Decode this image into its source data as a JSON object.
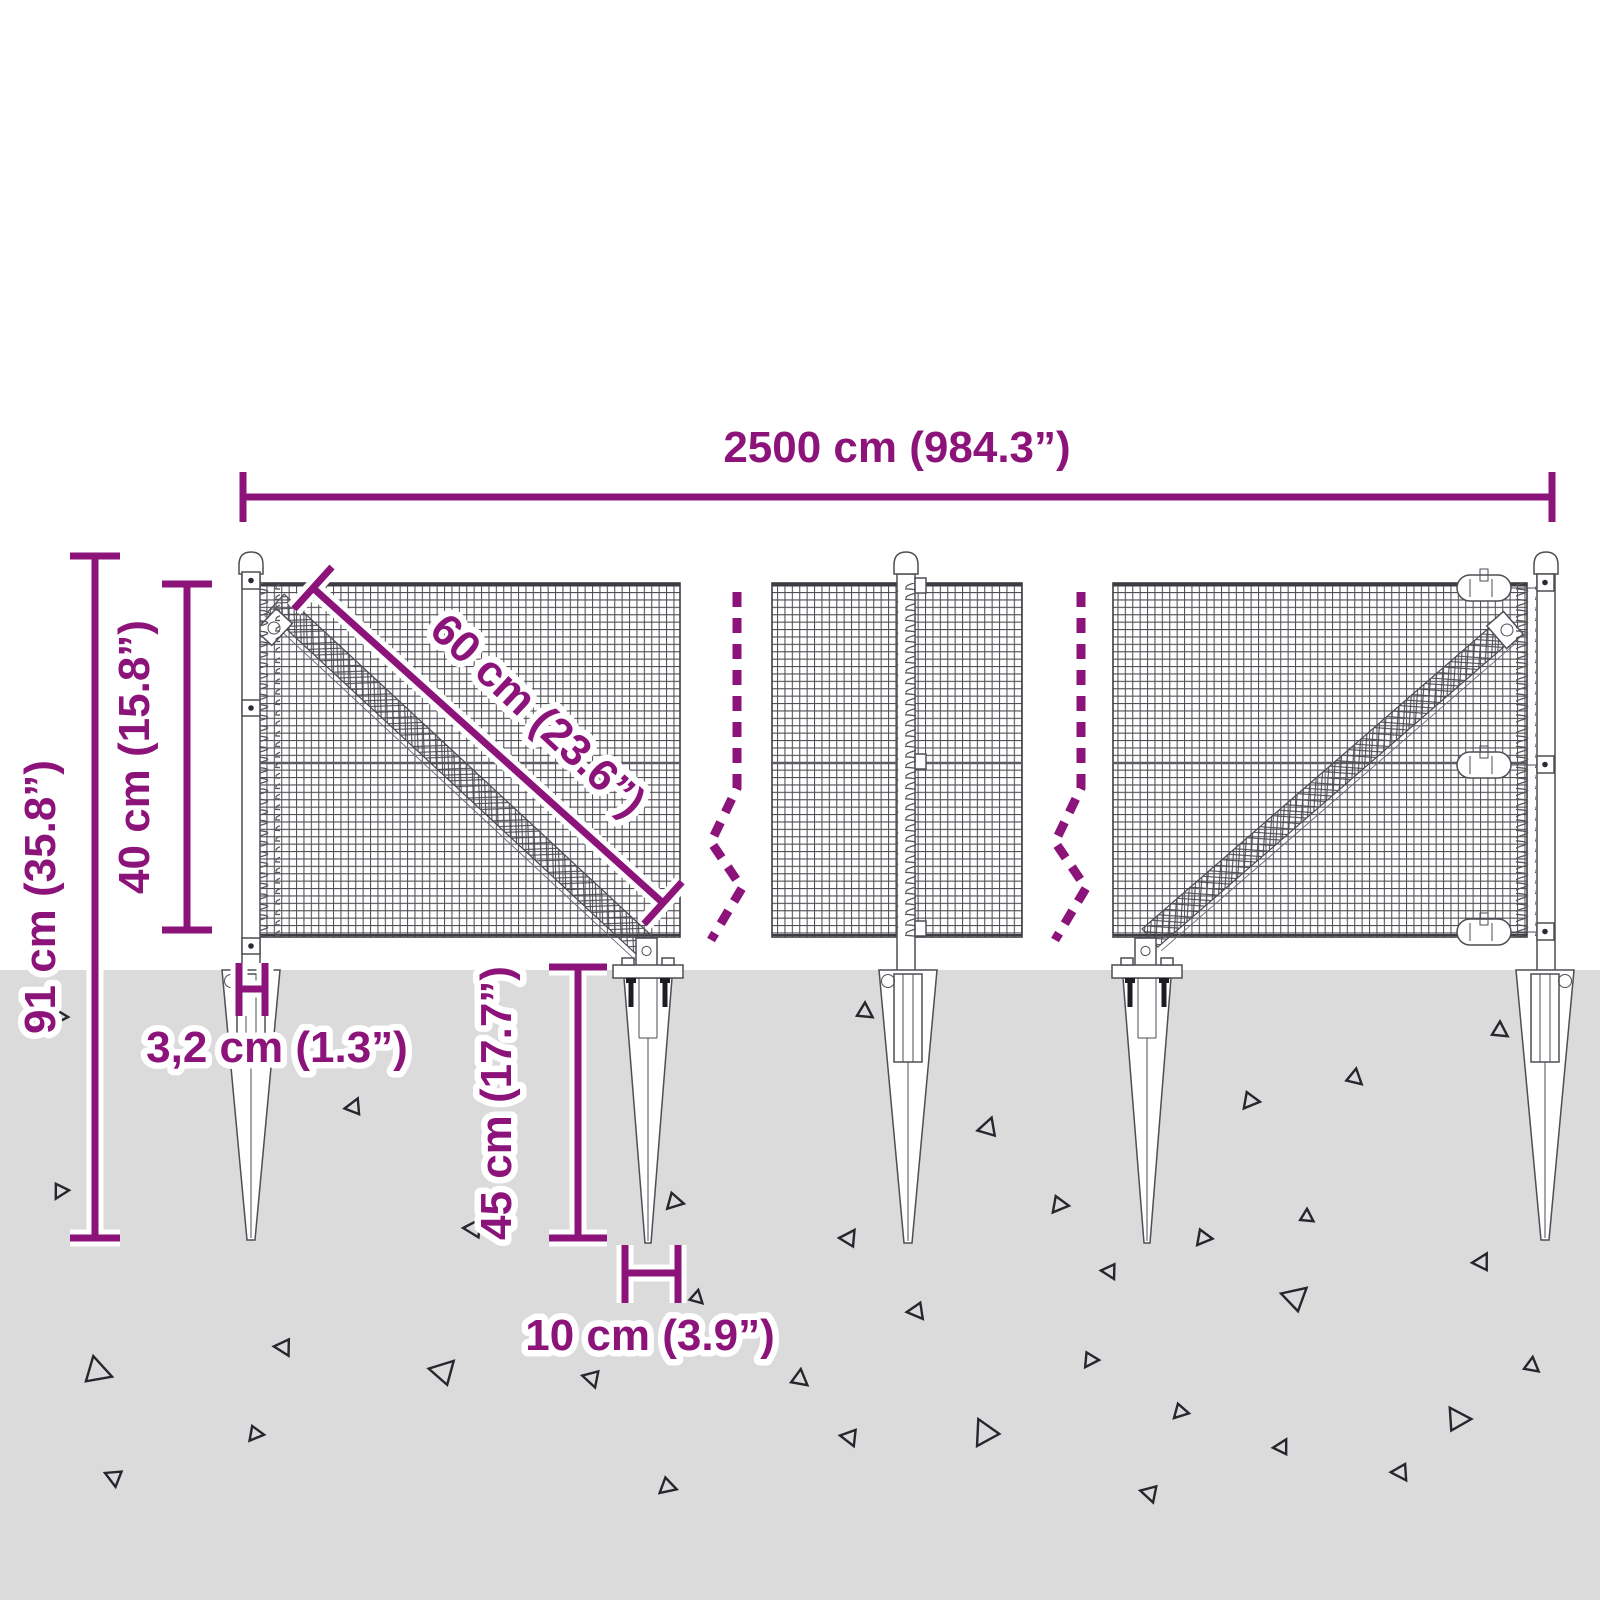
{
  "diagram": {
    "subject": "wire-mesh-fence-with-ground-spikes-dimension-diagram",
    "labels": {
      "total_width": "2500 cm (984.3”)",
      "overall_height": "91 cm (35.8”)",
      "mesh_height": "40 cm (15.8”)",
      "mesh_diagonal": "60 cm (23.6”)",
      "post_width": "3,2 cm (1.3”)",
      "spike_depth": "45 cm (17.7”)",
      "spike_width": "10 cm (3.9”)"
    }
  },
  "colors": {
    "accent": "#8c1379",
    "ground": "#dbdbdb",
    "line": "#4e4e54",
    "tri": "#26262e",
    "bg": "#ffffff"
  }
}
